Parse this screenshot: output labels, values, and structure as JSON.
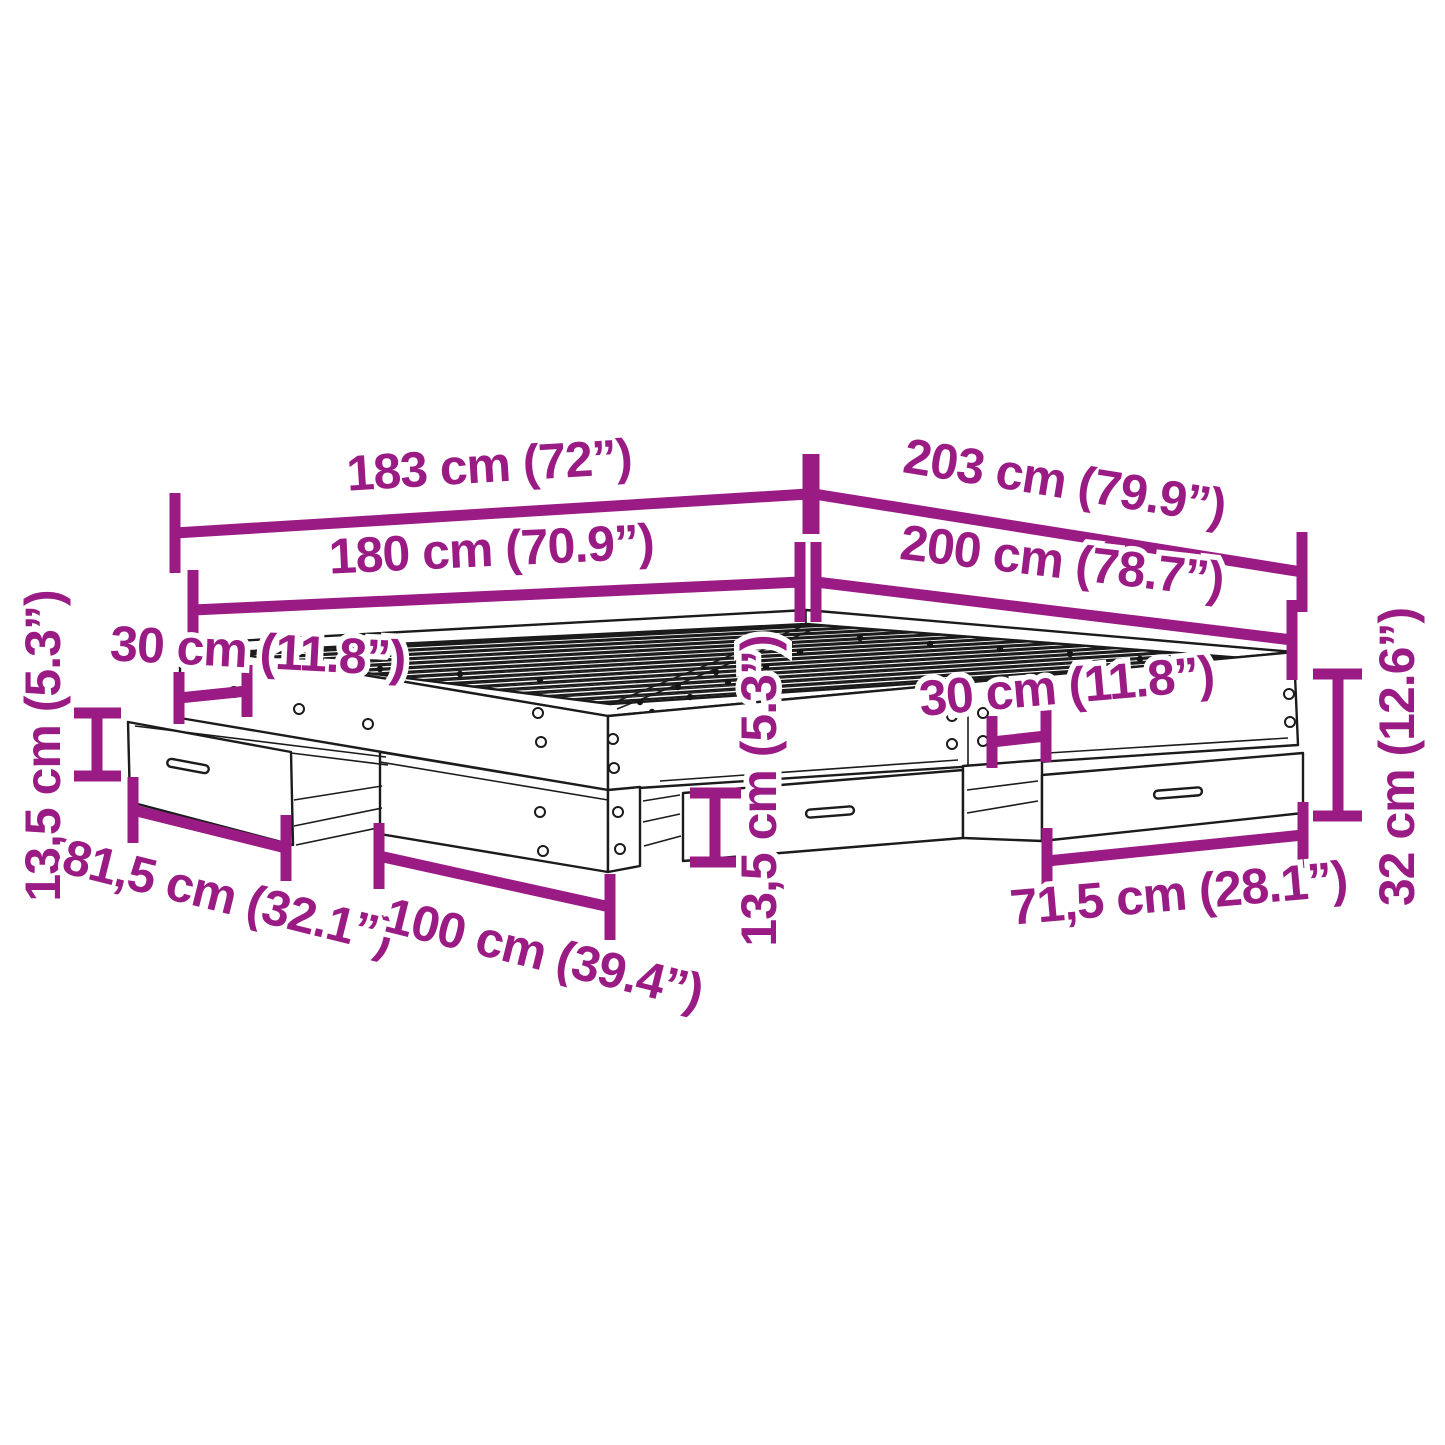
{
  "diagram": {
    "type": "product-dimension-diagram",
    "subject": "bed-frame-with-storage-drawers",
    "colors": {
      "dimension": "#9A1B84",
      "linework": "#1B1B1B",
      "background": "#FFFFFF"
    },
    "dimensions": [
      {
        "id": "outer-width",
        "label": "183 cm (72”)",
        "cm": 183,
        "inches": 72
      },
      {
        "id": "outer-length",
        "label": "203 cm (79.9”)",
        "cm": 203,
        "inches": 79.9
      },
      {
        "id": "inner-width",
        "label": "180 cm (70.9”)",
        "cm": 180,
        "inches": 70.9
      },
      {
        "id": "inner-length",
        "label": "200 cm (78.7”)",
        "cm": 200,
        "inches": 78.7
      },
      {
        "id": "drawer-offset-left",
        "label": "30 cm (11.8”)",
        "cm": 30,
        "inches": 11.8
      },
      {
        "id": "drawer-offset-right",
        "label": "30 cm (11.8”)",
        "cm": 30,
        "inches": 11.8
      },
      {
        "id": "drawer-height-left",
        "label": "13,5 cm (5.3”)",
        "cm": 13.5,
        "inches": 5.3
      },
      {
        "id": "drawer-height-center",
        "label": "13,5 cm (5.3”)",
        "cm": 13.5,
        "inches": 5.3
      },
      {
        "id": "drawer-front-left",
        "label": "81,5 cm (32.1”)",
        "cm": 81.5,
        "inches": 32.1
      },
      {
        "id": "side-panel-length",
        "label": "100 cm (39.4”)",
        "cm": 100,
        "inches": 39.4
      },
      {
        "id": "drawer-front-right",
        "label": "71,5 cm (28.1”)",
        "cm": 71.5,
        "inches": 28.1
      },
      {
        "id": "frame-height",
        "label": "32 cm (12.6”)",
        "cm": 32,
        "inches": 12.6
      }
    ]
  }
}
